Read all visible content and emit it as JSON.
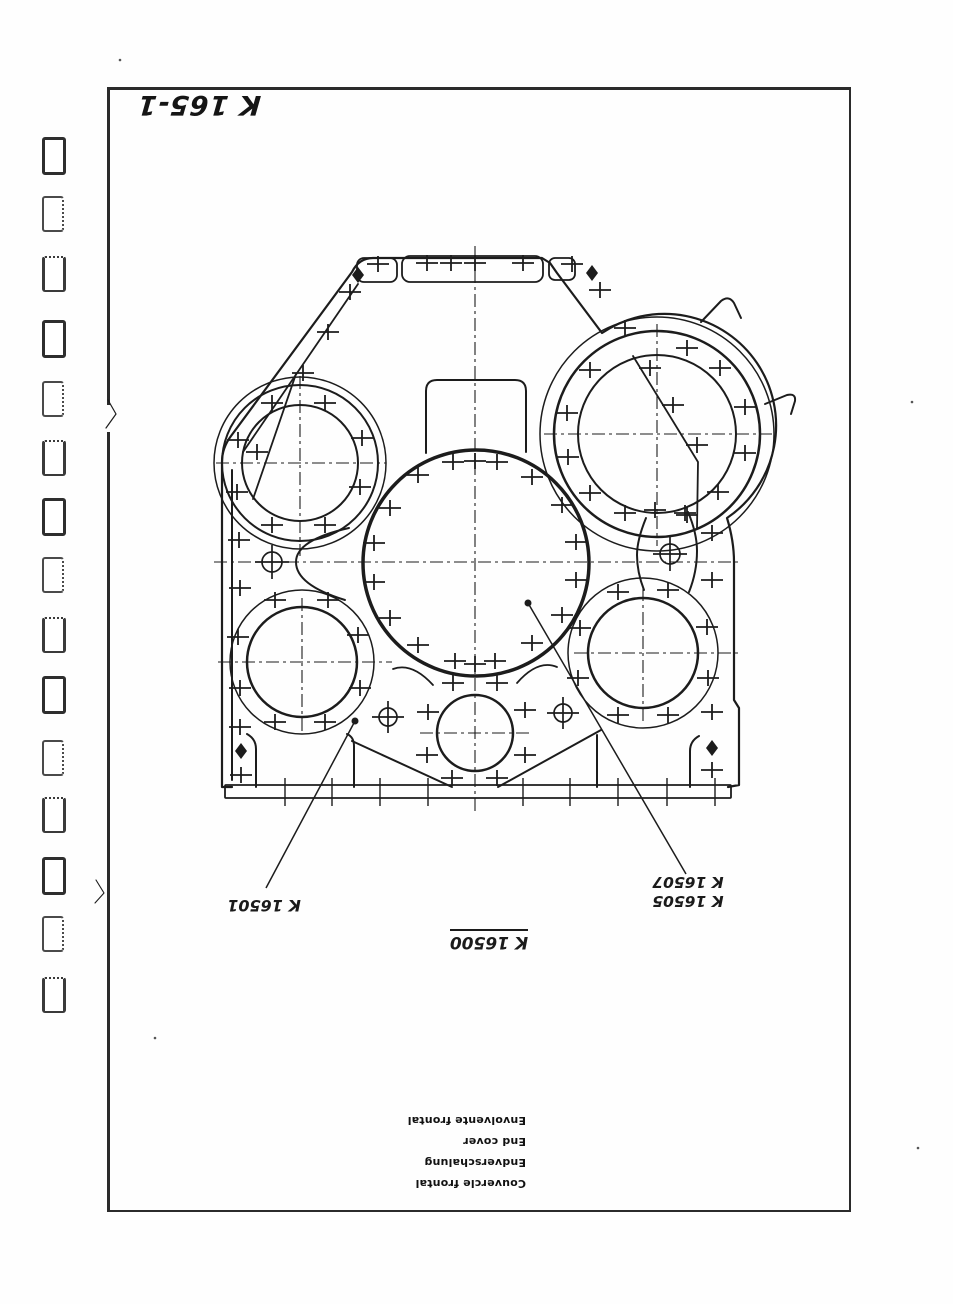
{
  "page": {
    "doc_number": "K 165-1",
    "part_labels": {
      "left": "K 16501",
      "right_line1": "K 16505",
      "right_line2": "K 16507",
      "main_assembly": "K 16500"
    },
    "caption_lines": [
      "Couvercle frontal",
      "Endverschalung",
      "End cover",
      "Envolvente frontal"
    ]
  },
  "binding": {
    "holes_y": [
      137,
      196,
      256,
      320,
      381,
      440,
      498,
      557,
      617,
      676,
      740,
      797,
      857,
      916,
      977
    ]
  },
  "drawing": {
    "ink": "#1c1c1c",
    "paths": [
      [
        "M 232,787 L 222,787 L 222,462 Q 222,448 231,436 L 352,272 Q 359,258 373,258 L 542,258 L 550,263 L 557,273 L 602,333 A 111,111 0 0 1 727,518 Q 734,541 734,562 L 734,700 L 739,708 L 739,785 L 728,787",
        2.2
      ],
      [
        "M 232,780 L 232,470",
        2
      ],
      [
        "M 243,452 L 358,284",
        1.8
      ],
      [
        "M 426,453 L 426,391 Q 426,380 437,380 L 515,380 Q 526,380 526,391 L 526,452",
        2
      ],
      [
        "M 349,528 Q 296,540 296,562 Q 296,585 345,600",
        2
      ],
      [
        "M 646,518 Q 637,540 637,555 Q 637,572 644,590",
        2
      ],
      [
        "M 688,512 Q 697,533 697,551 Q 697,572 689,592",
        2
      ],
      [
        "M 256,787 L 256,749 Q 256,739 247,734",
        2
      ],
      [
        "M 347,734 Q 354,737 354,746 L 354,787",
        2
      ],
      [
        "M 352,741 L 452,787",
        2
      ],
      [
        "M 601,730 L 498,787",
        2
      ],
      [
        "M 597,735 L 597,787",
        2
      ],
      [
        "M 690,787 L 690,751 Q 690,741 699,736",
        2
      ],
      [
        "M 433,685 Q 412,662 393,669",
        1.8
      ],
      [
        "M 517,683 Q 538,659 557,667",
        1.8
      ],
      [
        "M 701,322 L 721,301 Q 729,295 734,303 L 741,318",
        2
      ],
      [
        "M 765,404 L 787,395 Q 796,393 795,401 L 791,414",
        2
      ],
      [
        "M 296,374 L 253,499",
        1.8
      ],
      [
        "M 633,356 L 698,462 L 697,528",
        1.8
      ],
      [
        "M 108,400 L 116,414 L 106,428",
        1.2
      ],
      [
        "M 96,880 L 104,893 L 95,903",
        1.1
      ]
    ],
    "rects": [
      [
        402,
        256,
        141,
        26,
        8
      ],
      [
        357,
        258,
        40,
        24,
        7
      ],
      [
        549,
        258,
        26,
        22,
        6
      ],
      [
        225,
        785,
        506,
        13,
        1
      ]
    ],
    "circles": [
      [
        300,
        463,
        78,
        2
      ],
      [
        300,
        463,
        58,
        2
      ],
      [
        300,
        463,
        86,
        1.5
      ],
      [
        657,
        434,
        103,
        2.5
      ],
      [
        657,
        434,
        79,
        2
      ],
      [
        657,
        434,
        117,
        1.5
      ],
      [
        476,
        563,
        113,
        3.5
      ],
      [
        302,
        662,
        55,
        2.5
      ],
      [
        302,
        662,
        72,
        1.5
      ],
      [
        643,
        653,
        55,
        2.5
      ],
      [
        643,
        653,
        75,
        1.5
      ],
      [
        475,
        733,
        38,
        2.5
      ]
    ],
    "centerlines": [
      [
        475,
        246,
        475,
        812
      ],
      [
        214,
        562,
        742,
        562
      ],
      [
        300,
        376,
        300,
        556
      ],
      [
        216,
        463,
        386,
        463
      ],
      [
        657,
        324,
        657,
        546
      ],
      [
        544,
        434,
        772,
        434
      ],
      [
        302,
        598,
        302,
        732
      ],
      [
        218,
        662,
        392,
        662
      ],
      [
        643,
        588,
        643,
        722
      ],
      [
        574,
        653,
        742,
        653
      ],
      [
        420,
        733,
        532,
        733
      ]
    ],
    "crosses": [
      [
        378,
        264
      ],
      [
        427,
        263
      ],
      [
        451,
        263
      ],
      [
        475,
        263
      ],
      [
        523,
        263
      ],
      [
        572,
        264
      ],
      [
        600,
        290
      ],
      [
        350,
        292
      ],
      [
        328,
        332
      ],
      [
        303,
        373
      ],
      [
        238,
        440
      ],
      [
        237,
        492
      ],
      [
        239,
        540
      ],
      [
        240,
        588
      ],
      [
        238,
        637
      ],
      [
        240,
        688
      ],
      [
        240,
        727
      ],
      [
        241,
        775
      ],
      [
        272,
        403
      ],
      [
        325,
        403
      ],
      [
        362,
        438
      ],
      [
        257,
        452
      ],
      [
        360,
        487
      ],
      [
        272,
        525
      ],
      [
        325,
        525
      ],
      [
        625,
        328
      ],
      [
        687,
        348
      ],
      [
        590,
        370
      ],
      [
        650,
        368
      ],
      [
        720,
        368
      ],
      [
        567,
        413
      ],
      [
        673,
        405
      ],
      [
        745,
        407
      ],
      [
        568,
        457
      ],
      [
        697,
        445
      ],
      [
        745,
        453
      ],
      [
        590,
        493
      ],
      [
        718,
        492
      ],
      [
        625,
        513
      ],
      [
        655,
        510
      ],
      [
        687,
        515
      ],
      [
        453,
        462
      ],
      [
        475,
        461
      ],
      [
        497,
        462
      ],
      [
        418,
        475
      ],
      [
        532,
        477
      ],
      [
        390,
        508
      ],
      [
        562,
        505
      ],
      [
        374,
        543
      ],
      [
        576,
        542
      ],
      [
        374,
        582
      ],
      [
        576,
        580
      ],
      [
        390,
        618
      ],
      [
        562,
        615
      ],
      [
        418,
        645
      ],
      [
        532,
        643
      ],
      [
        455,
        661
      ],
      [
        475,
        664
      ],
      [
        495,
        661
      ],
      [
        275,
        600
      ],
      [
        328,
        600
      ],
      [
        358,
        635
      ],
      [
        360,
        688
      ],
      [
        275,
        722
      ],
      [
        325,
        722
      ],
      [
        618,
        592
      ],
      [
        668,
        590
      ],
      [
        580,
        628
      ],
      [
        707,
        627
      ],
      [
        578,
        678
      ],
      [
        708,
        678
      ],
      [
        618,
        715
      ],
      [
        668,
        715
      ],
      [
        712,
        533
      ],
      [
        712,
        580
      ],
      [
        712,
        712
      ],
      [
        712,
        770
      ],
      [
        685,
        513
      ],
      [
        453,
        683
      ],
      [
        497,
        683
      ],
      [
        428,
        712
      ],
      [
        525,
        710
      ],
      [
        427,
        755
      ],
      [
        525,
        755
      ],
      [
        452,
        778
      ],
      [
        497,
        778
      ]
    ],
    "diamonds": [
      [
        358,
        275
      ],
      [
        592,
        273
      ],
      [
        241,
        751
      ],
      [
        712,
        748
      ]
    ],
    "bolt_circles": [
      [
        272,
        562,
        10
      ],
      [
        670,
        554,
        10
      ],
      [
        388,
        717,
        9
      ],
      [
        563,
        713,
        9
      ]
    ],
    "leaders": [
      [
        355,
        721,
        266,
        888
      ],
      [
        528,
        603,
        686,
        874
      ]
    ],
    "leader_dots": [
      [
        528,
        603
      ],
      [
        355,
        721
      ]
    ],
    "base_ticks_x": [
      285,
      332,
      380,
      428,
      523,
      570,
      618,
      667,
      715
    ],
    "specks": [
      [
        912,
        402
      ],
      [
        120,
        60
      ],
      [
        155,
        1038
      ],
      [
        918,
        1148
      ]
    ]
  }
}
